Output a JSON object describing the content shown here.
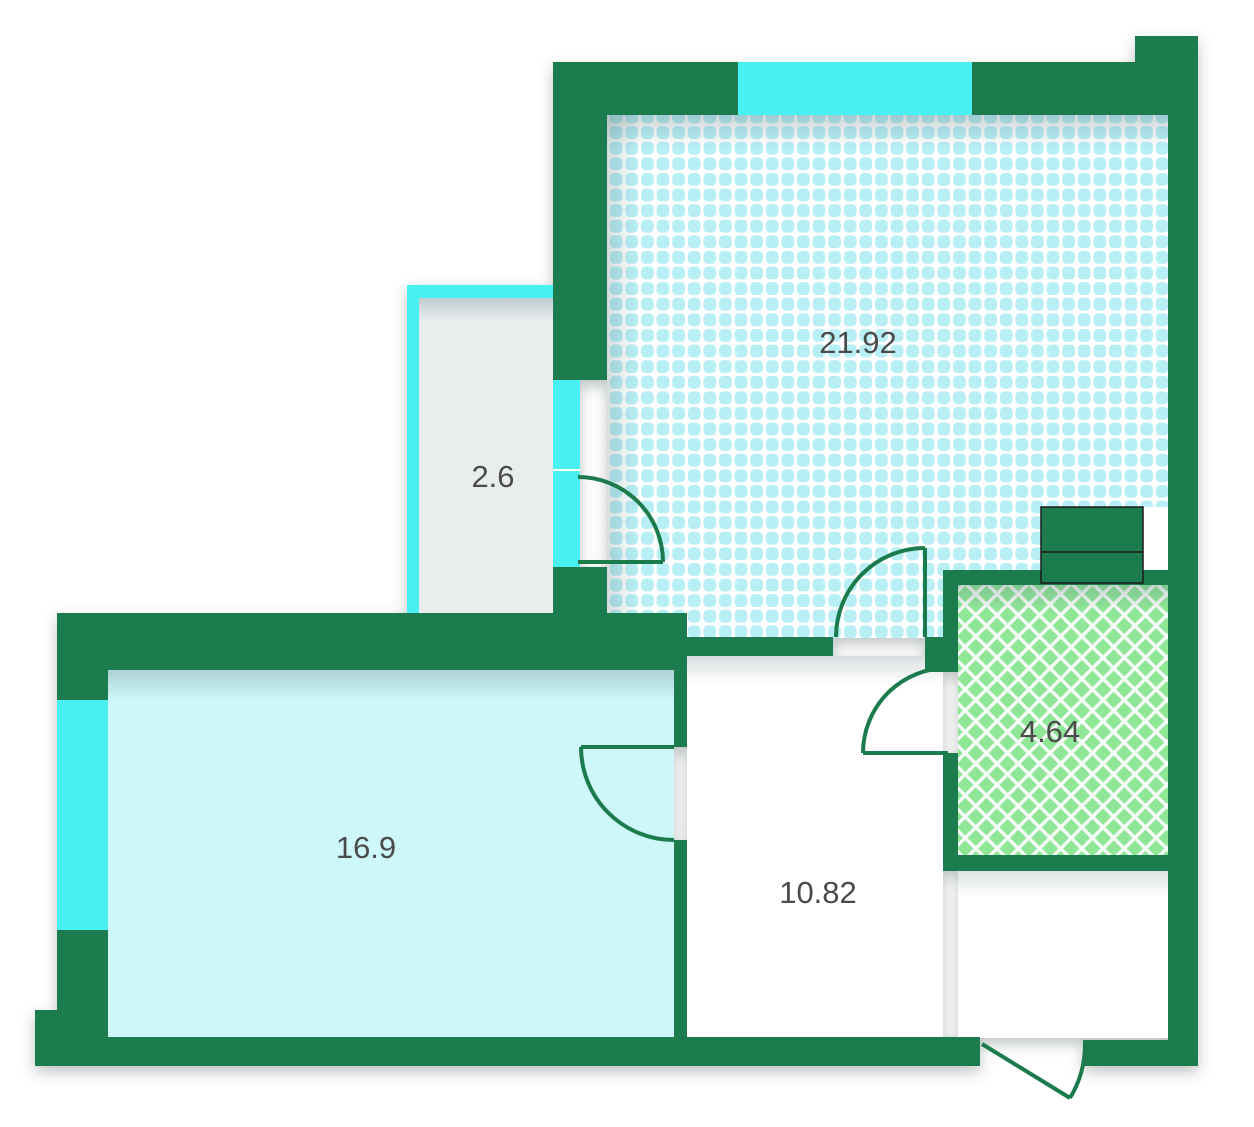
{
  "floor_plan": {
    "type": "apartment-floor-plan",
    "rooms": [
      {
        "name": "living-room",
        "area": "21.92"
      },
      {
        "name": "balcony",
        "area": "2.6"
      },
      {
        "name": "bedroom",
        "area": "16.9"
      },
      {
        "name": "hallway",
        "area": "10.82"
      },
      {
        "name": "bathroom",
        "area": "4.64"
      }
    ],
    "colors": {
      "wall": "#1C7B4D",
      "window": "#4AF0F2",
      "living_room_pattern": "#B7EFF5",
      "bedroom_fill": "#CEF7FA",
      "balcony_fill": "#E9EDEE",
      "bathroom_pattern": "#8FE697",
      "label_text": "#4B4B4B",
      "shaft_outline": "#1D1D1B"
    }
  }
}
